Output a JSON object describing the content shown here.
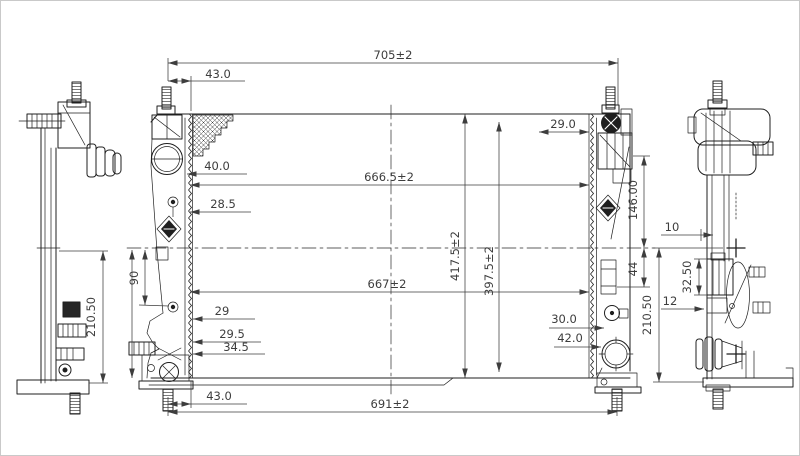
{
  "colors": {
    "background": "#ffffff",
    "line": "#1f1f1f",
    "dimension": "#3d3d3d"
  },
  "front_view": {
    "dims": {
      "overall_width_top": "705±2",
      "top_left_offset": "43.0",
      "top_right_offset": "29.0",
      "core_width_upper": "666.5±2",
      "inlet_port_diameter": "40.0",
      "upper_mount_offset": "28.5",
      "left_bracket_span": "90",
      "core_width_lower": "667±2",
      "overall_height": "417.5±2",
      "core_height": "397.5±2",
      "right_tank_upper_height": "146.00",
      "right_tank_lower_offset": "44",
      "lower_left_offset_1": "29",
      "lower_left_offset_2": "29.5",
      "lower_left_offset_3": "34.5",
      "sensor_port_diameter": "30.0",
      "outlet_port_diameter": "42.0",
      "bottom_left_offset": "43.0",
      "overall_width_bottom": "691±2"
    }
  },
  "left_view": {
    "dims": {
      "mount_height": "210.50"
    }
  },
  "right_view": {
    "dims": {
      "pin_offset": "10",
      "bracket_height": "32.50",
      "step_offset": "12",
      "mount_height": "210.50"
    }
  }
}
